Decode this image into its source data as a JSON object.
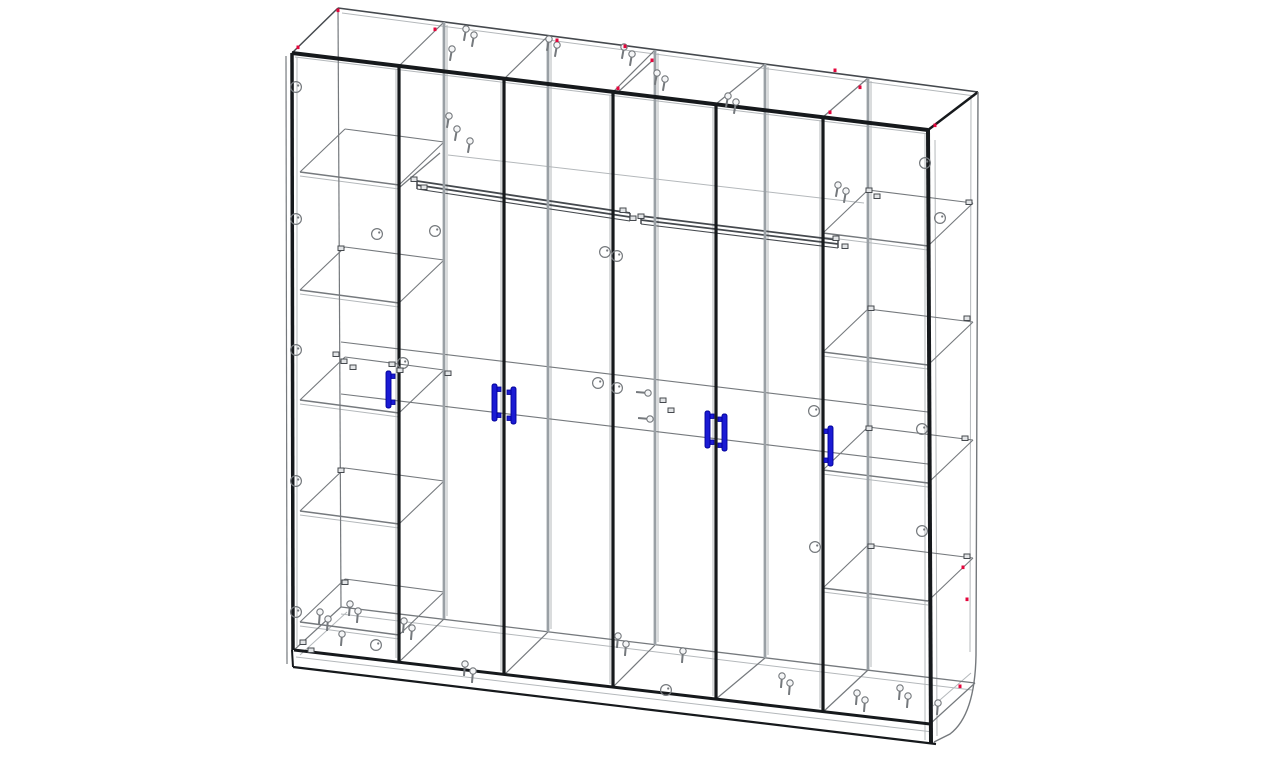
{
  "meta": {
    "title": "Six-door wardrobe — transparent wireframe assembly drawing",
    "drawing_type": "CAD wireframe, perspective view",
    "components": {
      "doors": 6,
      "handles": 6,
      "shelves_left_column": 5,
      "shelves_right_column": 4,
      "hanging_rods": 2
    }
  },
  "colors": {
    "background": "#ffffff",
    "edge": "#16191c",
    "dark": "#45494e",
    "line": "#75797d",
    "light": "#b4b8bb",
    "partition": "#9aa0a5",
    "handle": "#1b1bd4",
    "handle_stroke": "#000099",
    "marker_red": "#e4063c",
    "hardware_fill": "#e3e5e7",
    "screw_fill": "#f5f6f7"
  },
  "drawing": {
    "lines": [
      [
        295,
        57,
        929,
        134,
        1,
        "light"
      ],
      [
        342,
        13,
        975,
        96,
        1,
        "light"
      ],
      [
        297,
        57,
        297,
        646,
        1,
        "light"
      ],
      [
        396,
        69,
        396,
        658,
        1,
        "light"
      ],
      [
        501,
        82,
        501,
        671,
        1,
        "light"
      ],
      [
        610,
        95,
        610,
        684,
        1,
        "light"
      ],
      [
        713,
        107,
        713,
        696,
        1,
        "light"
      ],
      [
        820,
        120,
        820,
        708,
        1,
        "light"
      ],
      [
        925,
        133,
        925,
        740,
        1,
        "light"
      ],
      [
        447,
        25,
        447,
        616,
        1,
        "light"
      ],
      [
        551,
        39,
        551,
        629,
        1,
        "light"
      ],
      [
        658,
        53,
        658,
        642,
        1,
        "light"
      ],
      [
        768,
        67,
        768,
        655,
        1,
        "light"
      ],
      [
        871,
        81,
        871,
        667,
        1,
        "light"
      ],
      [
        448,
        155,
        864,
        203,
        1,
        "light"
      ],
      [
        296,
        657,
        933,
        732,
        1,
        "light"
      ],
      [
        341,
        614,
        972,
        690,
        1,
        "light"
      ],
      [
        935,
        140,
        937,
        736,
        1,
        "light"
      ],
      [
        971,
        97,
        970,
        652,
        1,
        "light"
      ],
      [
        933,
        706,
        971,
        673,
        1,
        "light"
      ],
      [
        300,
        655,
        347,
        612,
        1,
        "light"
      ],
      [
        300,
        176,
        399,
        189,
        1,
        "light"
      ],
      [
        300,
        294,
        399,
        307,
        1,
        "light"
      ],
      [
        300,
        404,
        399,
        417,
        1,
        "light"
      ],
      [
        300,
        515,
        399,
        528,
        1,
        "light"
      ],
      [
        300,
        626,
        399,
        639,
        1,
        "light"
      ],
      [
        823,
        237,
        928,
        250,
        1,
        "light"
      ],
      [
        823,
        356,
        928,
        369,
        1,
        "light"
      ],
      [
        823,
        474,
        928,
        487,
        1,
        "light"
      ],
      [
        823,
        592,
        928,
        605,
        1,
        "light"
      ],
      [
        286,
        56,
        287,
        664,
        1.2,
        "line"
      ],
      [
        338,
        8,
        341,
        607,
        1.2,
        "line"
      ],
      [
        341,
        342,
        928,
        412,
        1.1,
        "line"
      ],
      [
        341,
        394,
        928,
        464,
        1.1,
        "line"
      ],
      [
        341,
        607,
        975,
        683,
        1.3,
        "line"
      ],
      [
        444,
        22,
        399,
        66,
        1.2,
        "line"
      ],
      [
        548,
        36,
        504,
        79,
        1.2,
        "line"
      ],
      [
        655,
        50,
        613,
        92,
        1.2,
        "line"
      ],
      [
        765,
        64,
        716,
        104,
        1.2,
        "line"
      ],
      [
        868,
        78,
        823,
        117,
        1.2,
        "line"
      ],
      [
        399,
        662,
        444,
        619,
        1.2,
        "line"
      ],
      [
        504,
        675,
        548,
        632,
        1.2,
        "line"
      ],
      [
        613,
        687,
        655,
        645,
        1.2,
        "line"
      ],
      [
        716,
        699,
        765,
        658,
        1.2,
        "line"
      ],
      [
        823,
        712,
        868,
        670,
        1.2,
        "line"
      ],
      [
        294,
        650,
        341,
        607,
        1.2,
        "line"
      ],
      [
        930,
        724,
        975,
        683,
        1.2,
        "line"
      ],
      [
        400,
        187,
        440,
        153,
        1.2,
        "line"
      ],
      [
        617,
        93,
        653,
        60,
        1.2,
        "line"
      ],
      [
        300,
        172,
        399,
        185,
        1.4,
        "line"
      ],
      [
        399,
        185,
        444,
        142,
        1.1,
        "line"
      ],
      [
        444,
        142,
        345,
        129,
        1.1,
        "line"
      ],
      [
        345,
        129,
        300,
        172,
        1.1,
        "line"
      ],
      [
        300,
        290,
        399,
        303,
        1.4,
        "line"
      ],
      [
        399,
        303,
        444,
        260,
        1.1,
        "line"
      ],
      [
        444,
        260,
        345,
        247,
        1.1,
        "line"
      ],
      [
        345,
        247,
        300,
        290,
        1.1,
        "line"
      ],
      [
        300,
        400,
        399,
        413,
        1.4,
        "line"
      ],
      [
        399,
        413,
        444,
        370,
        1.1,
        "line"
      ],
      [
        444,
        370,
        345,
        357,
        1.1,
        "line"
      ],
      [
        345,
        357,
        300,
        400,
        1.1,
        "line"
      ],
      [
        300,
        511,
        399,
        524,
        1.4,
        "line"
      ],
      [
        399,
        524,
        444,
        481,
        1.1,
        "line"
      ],
      [
        444,
        481,
        345,
        468,
        1.1,
        "line"
      ],
      [
        345,
        468,
        300,
        511,
        1.1,
        "line"
      ],
      [
        300,
        622,
        399,
        635,
        1.4,
        "line"
      ],
      [
        399,
        635,
        444,
        592,
        1.1,
        "line"
      ],
      [
        444,
        592,
        345,
        579,
        1.1,
        "line"
      ],
      [
        345,
        579,
        300,
        622,
        1.1,
        "line"
      ],
      [
        823,
        233,
        928,
        246,
        1.4,
        "line"
      ],
      [
        928,
        246,
        973,
        203,
        1.1,
        "line"
      ],
      [
        973,
        203,
        868,
        190,
        1.1,
        "line"
      ],
      [
        868,
        190,
        823,
        233,
        1.1,
        "line"
      ],
      [
        823,
        352,
        928,
        365,
        1.4,
        "line"
      ],
      [
        928,
        365,
        973,
        322,
        1.1,
        "line"
      ],
      [
        973,
        322,
        868,
        309,
        1.1,
        "line"
      ],
      [
        868,
        309,
        823,
        352,
        1.1,
        "line"
      ],
      [
        823,
        470,
        928,
        483,
        1.4,
        "line"
      ],
      [
        928,
        483,
        973,
        440,
        1.1,
        "line"
      ],
      [
        973,
        440,
        868,
        427,
        1.1,
        "line"
      ],
      [
        868,
        427,
        823,
        470,
        1.1,
        "line"
      ],
      [
        823,
        588,
        928,
        601,
        1.4,
        "line"
      ],
      [
        928,
        601,
        973,
        558,
        1.1,
        "line"
      ],
      [
        973,
        558,
        868,
        545,
        1.1,
        "line"
      ],
      [
        868,
        545,
        823,
        588,
        1.1,
        "line"
      ],
      [
        338,
        8,
        978,
        92,
        1.6,
        "dark"
      ],
      [
        292,
        53,
        338,
        8,
        1.5,
        "dark"
      ],
      [
        417,
        181,
        630,
        213,
        1.8,
        "dark"
      ],
      [
        417,
        185,
        630,
        217,
        1.8,
        "dark"
      ],
      [
        417,
        189,
        630,
        221,
        1.1,
        "dark"
      ],
      [
        417,
        181,
        417,
        189,
        1.5,
        "dark"
      ],
      [
        630,
        213,
        630,
        221,
        1.5,
        "dark"
      ],
      [
        641,
        216,
        838,
        240,
        1.8,
        "dark"
      ],
      [
        641,
        220,
        838,
        244,
        1.8,
        "dark"
      ],
      [
        641,
        224,
        838,
        248,
        1.1,
        "dark"
      ],
      [
        641,
        216,
        641,
        224,
        1.5,
        "dark"
      ],
      [
        838,
        240,
        838,
        248,
        1.5,
        "dark"
      ],
      [
        444,
        22,
        444,
        619,
        2.8,
        "partition"
      ],
      [
        548,
        36,
        548,
        632,
        2.8,
        "partition"
      ],
      [
        655,
        50,
        655,
        645,
        2.8,
        "partition"
      ],
      [
        765,
        64,
        765,
        658,
        2.8,
        "partition"
      ],
      [
        868,
        78,
        868,
        670,
        2.8,
        "partition"
      ],
      [
        292,
        53,
        928,
        130,
        4,
        "edge"
      ],
      [
        292,
        53,
        293,
        650,
        3.5,
        "edge"
      ],
      [
        399,
        66,
        399,
        662,
        3.2,
        "edge"
      ],
      [
        504,
        79,
        504,
        675,
        3.2,
        "edge"
      ],
      [
        613,
        92,
        613,
        687,
        3.2,
        "edge"
      ],
      [
        716,
        104,
        716,
        699,
        3.2,
        "edge"
      ],
      [
        823,
        117,
        823,
        712,
        3.2,
        "edge"
      ],
      [
        928,
        130,
        931,
        743,
        4,
        "edge"
      ],
      [
        928,
        130,
        978,
        92,
        2.5,
        "edge"
      ],
      [
        294,
        650,
        930,
        724,
        3,
        "edge"
      ],
      [
        293,
        667,
        936,
        744,
        2.2,
        "edge"
      ],
      [
        292,
        650,
        293,
        667,
        2,
        "edge"
      ]
    ],
    "paths": [
      {
        "d": "M978,92 L976,655 Q975,715 950,734 L934,742",
        "w": 1.4,
        "c": "line"
      }
    ],
    "screws": [
      [
        466,
        29,
        100
      ],
      [
        474,
        35,
        100
      ],
      [
        452,
        49,
        100
      ],
      [
        549,
        39,
        100
      ],
      [
        557,
        45,
        100
      ],
      [
        624,
        47,
        100
      ],
      [
        632,
        54,
        100
      ],
      [
        657,
        73,
        100
      ],
      [
        665,
        79,
        100
      ],
      [
        728,
        96,
        100
      ],
      [
        736,
        102,
        100
      ],
      [
        838,
        185,
        100
      ],
      [
        846,
        191,
        100
      ],
      [
        449,
        116,
        100
      ],
      [
        457,
        129,
        100
      ],
      [
        470,
        141,
        100
      ],
      [
        648,
        393,
        185
      ],
      [
        650,
        419,
        185
      ],
      [
        320,
        612,
        95
      ],
      [
        328,
        619,
        95
      ],
      [
        350,
        604,
        95
      ],
      [
        358,
        611,
        95
      ],
      [
        404,
        621,
        95
      ],
      [
        412,
        628,
        95
      ],
      [
        342,
        634,
        95
      ],
      [
        465,
        664,
        95
      ],
      [
        473,
        671,
        95
      ],
      [
        618,
        636,
        95
      ],
      [
        626,
        644,
        95
      ],
      [
        683,
        651,
        95
      ],
      [
        782,
        676,
        95
      ],
      [
        790,
        683,
        95
      ],
      [
        857,
        693,
        95
      ],
      [
        865,
        700,
        95
      ],
      [
        900,
        688,
        95
      ],
      [
        908,
        696,
        95
      ],
      [
        938,
        703,
        95
      ]
    ],
    "cam_locks": [
      [
        296,
        87
      ],
      [
        296,
        219
      ],
      [
        296,
        350
      ],
      [
        296,
        481
      ],
      [
        296,
        612
      ],
      [
        377,
        234
      ],
      [
        435,
        231
      ],
      [
        403,
        363
      ],
      [
        605,
        252
      ],
      [
        617,
        256
      ],
      [
        598,
        383
      ],
      [
        617,
        388
      ],
      [
        814,
        411
      ],
      [
        922,
        429
      ],
      [
        922,
        531
      ],
      [
        815,
        547
      ],
      [
        376,
        645
      ],
      [
        666,
        690
      ],
      [
        925,
        163
      ],
      [
        940,
        218
      ]
    ],
    "hardware": [
      [
        411,
        177
      ],
      [
        421,
        185
      ],
      [
        620,
        208
      ],
      [
        630,
        216
      ],
      [
        638,
        214
      ],
      [
        833,
        236
      ],
      [
        842,
        244
      ],
      [
        333,
        352
      ],
      [
        341,
        359
      ],
      [
        350,
        365
      ],
      [
        389,
        362
      ],
      [
        397,
        368
      ],
      [
        445,
        371
      ],
      [
        338,
        246
      ],
      [
        338,
        468
      ],
      [
        342,
        580
      ],
      [
        866,
        188
      ],
      [
        874,
        194
      ],
      [
        966,
        200
      ],
      [
        868,
        306
      ],
      [
        964,
        316
      ],
      [
        866,
        426
      ],
      [
        962,
        436
      ],
      [
        868,
        544
      ],
      [
        964,
        554
      ],
      [
        300,
        640
      ],
      [
        308,
        648
      ],
      [
        660,
        398
      ],
      [
        668,
        408
      ]
    ],
    "red_marks": [
      [
        298,
        47
      ],
      [
        338,
        10
      ],
      [
        435,
        29
      ],
      [
        557,
        40
      ],
      [
        625,
        46
      ],
      [
        652,
        60
      ],
      [
        618,
        88
      ],
      [
        835,
        70
      ],
      [
        860,
        87
      ],
      [
        830,
        112
      ],
      [
        935,
        125
      ],
      [
        963,
        567
      ],
      [
        967,
        599
      ],
      [
        960,
        686
      ]
    ],
    "handles": [
      {
        "x": 386,
        "y": 371,
        "h": 37,
        "d": 1
      },
      {
        "x": 492,
        "y": 384,
        "h": 37,
        "d": 1
      },
      {
        "x": 511,
        "y": 387,
        "h": 37,
        "d": -1
      },
      {
        "x": 705,
        "y": 411,
        "h": 37,
        "d": 1
      },
      {
        "x": 722,
        "y": 414,
        "h": 37,
        "d": -1
      },
      {
        "x": 828,
        "y": 426,
        "h": 40,
        "d": -1
      }
    ]
  }
}
